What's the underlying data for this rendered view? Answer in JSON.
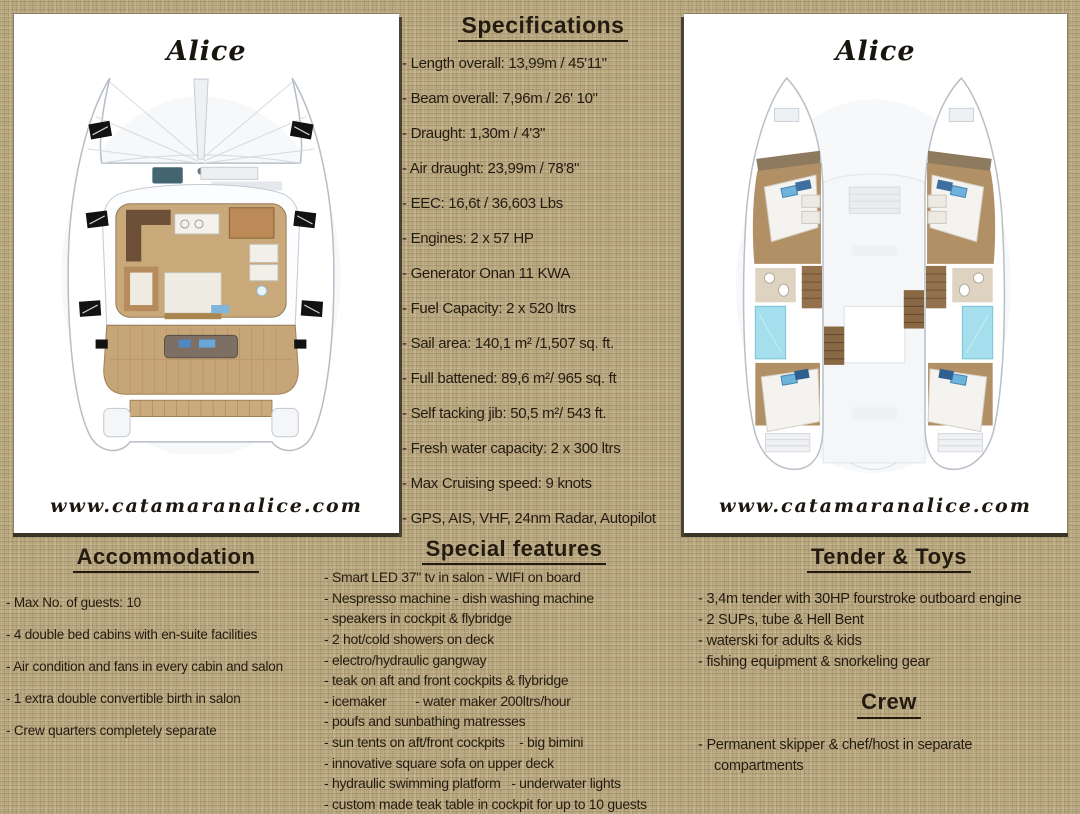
{
  "left_panel": {
    "title": "Alice",
    "website": "www.catamaranalice.com"
  },
  "right_panel": {
    "title": "Alice",
    "website": "www.catamaranalice.com"
  },
  "specifications": {
    "heading": "Specifications",
    "items": [
      "- Length overall: 13,99m / 45'11\"",
      "- Beam overall: 7,96m / 26' 10\"",
      "- Draught: 1,30m / 4'3\"",
      "- Air draught: 23,99m / 78'8\"",
      "- EEC: 16,6t / 36,603 Lbs",
      "- Engines: 2 x 57 HP",
      "- Generator Onan 11 KWA",
      "- Fuel Capacity: 2 x 520 ltrs",
      "- Sail area: 140,1 m² /1,507 sq. ft.",
      "- Full battened: 89,6 m²/ 965 sq. ft",
      "- Self tacking jib: 50,5 m²/ 543 ft.",
      "- Fresh water capacity: 2 x 300 ltrs",
      "- Max Cruising speed: 9 knots",
      "- GPS, AIS, VHF, 24nm Radar, Autopilot"
    ]
  },
  "accommodation": {
    "heading": "Accommodation",
    "items": [
      "- Max No. of guests: 10",
      "- 4 double bed cabins with en-suite facilities",
      "- Air condition and fans in every cabin and salon",
      "- 1 extra double convertible birth in salon",
      "- Crew quarters completely separate"
    ]
  },
  "special_features": {
    "heading": "Special features",
    "items": [
      "- Smart LED 37\" tv in salon - WIFI on board",
      "- Nespresso machine - dish washing machine",
      "- speakers in cockpit & flybridge",
      "- 2 hot/cold showers on deck",
      "- electro/hydraulic gangway",
      "- teak on aft and front cockpits & flybridge",
      "- icemaker        - water maker 200ltrs/hour",
      "- poufs and sunbathing matresses",
      "- sun tents on aft/front cockpits    - big bimini",
      "- innovative square sofa on upper deck",
      "- hydraulic swimming platform   - underwater lights",
      "- custom made teak table in cockpit for up to 10 guests"
    ]
  },
  "tender_and_toys": {
    "heading": "Tender & Toys",
    "items": [
      "- 3,4m tender with 30HP fourstroke outboard engine",
      "- 2 SUPs, tube & Hell Bent",
      "- waterski for adults & kids",
      "- fishing equipment & snorkeling gear"
    ]
  },
  "crew": {
    "heading": "Crew",
    "items": [
      "- Permanent skipper & chef/host in separate compartments"
    ]
  },
  "graphics": {
    "deck_plan": "deck-plan-top-view",
    "hull_plan": "cabin-layout-lower-deck"
  },
  "colors": {
    "background_burlap": "#b9a87f",
    "panel_background": "#ffffff",
    "panel_border_dark": "#3a3426",
    "text": "#241b10",
    "wood_floor": "#c9a87a",
    "teak_deck": "#c6a578",
    "cabin_wood": "#b19066",
    "bathroom_blue": "#a5dfed",
    "pillow_blue": "#6db3dc",
    "hatch_black": "#121212"
  }
}
